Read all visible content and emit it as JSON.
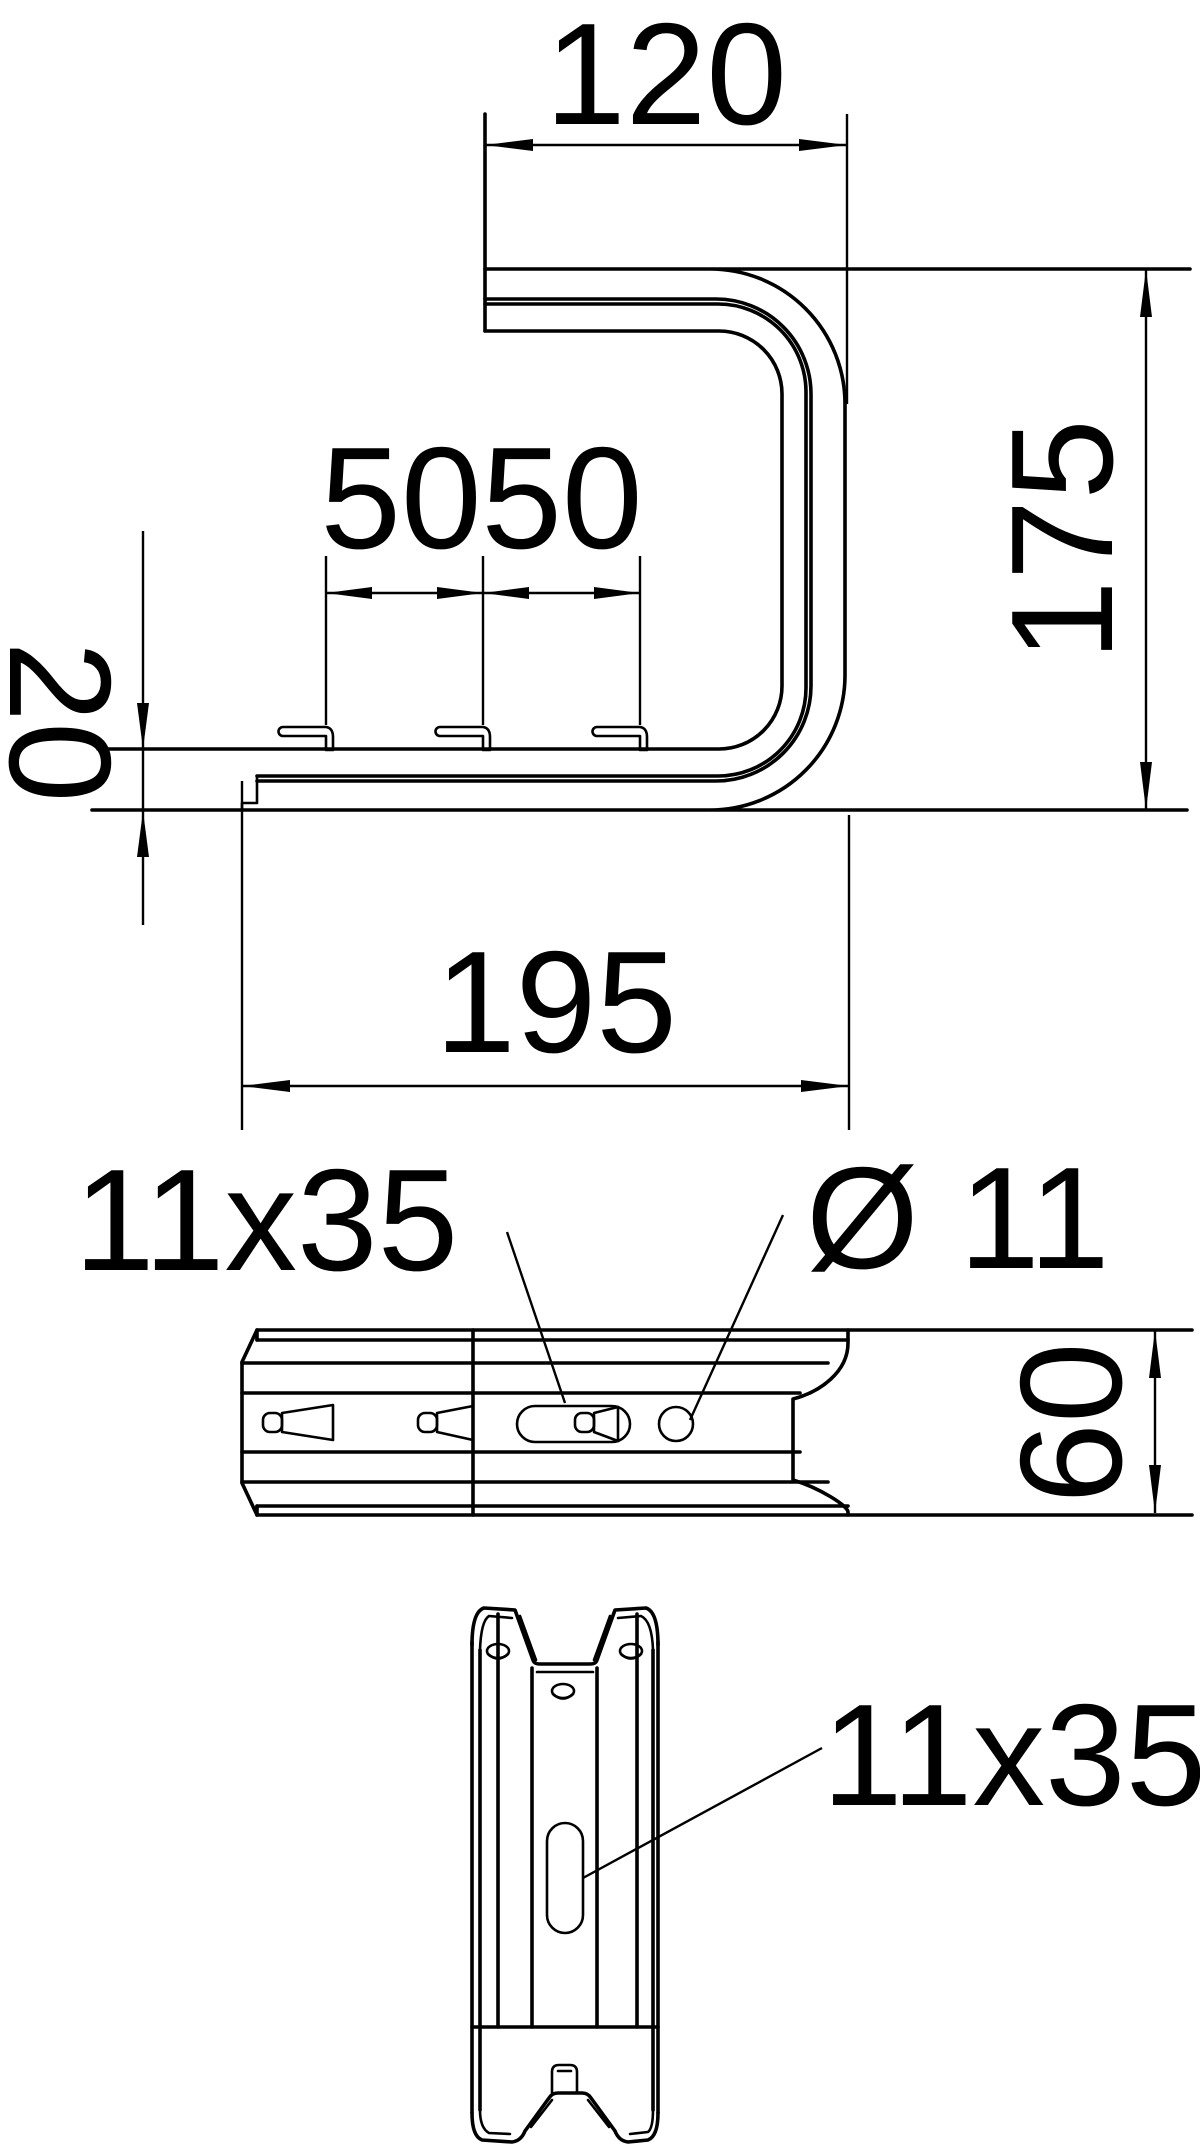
{
  "drawing": {
    "colors": {
      "background": "#ffffff",
      "line": "#000000"
    },
    "side_view": {
      "dim_top_width": "120",
      "dim_height": "175",
      "dim_base_height": "20",
      "dim_hook_pitch_1": "50",
      "dim_hook_pitch_2": "50",
      "dim_bottom_width": "195"
    },
    "front_view": {
      "slot_label": "11x35",
      "hole_label": "Ø 11",
      "dim_height": "60"
    },
    "plan_view": {
      "slot_label": "11x35"
    }
  }
}
